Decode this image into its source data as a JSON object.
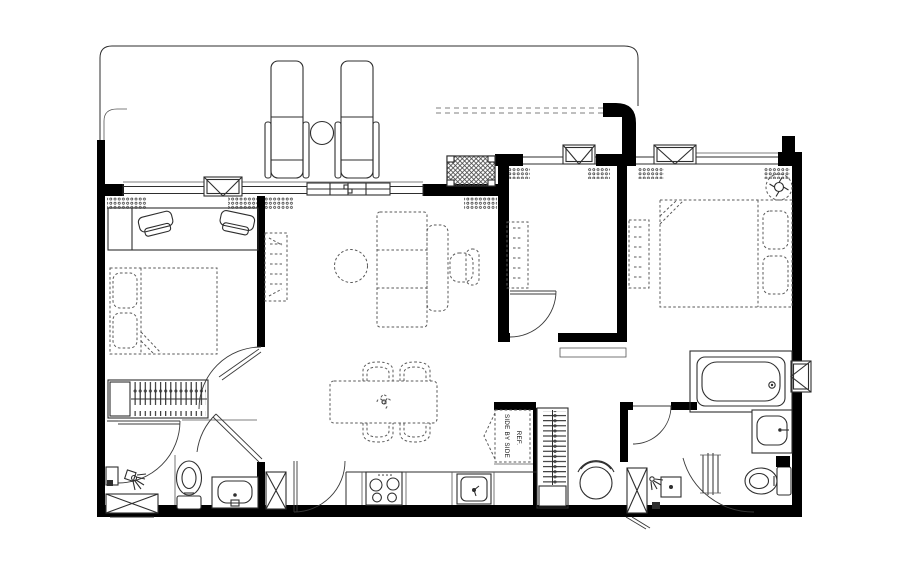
{
  "canvas": {
    "width": 900,
    "height": 563,
    "background": "#ffffff"
  },
  "palette": {
    "wall": "#000000",
    "line": "#2e2e2e",
    "furniture_dash": "#5a5a5a",
    "hatch": "#2e2e2e",
    "background": "#ffffff"
  },
  "labels": {
    "refrigerator_line1": "REF.",
    "refrigerator_line2": "SIDE BY SIDE"
  },
  "plan": {
    "type": "apartment-floor-plan",
    "areas": {
      "balcony": [
        "sun-lounger",
        "sun-lounger",
        "round-side-table",
        "railing"
      ],
      "bedroom_left": [
        "desk",
        "desk-chair",
        "desk-chair",
        "double-bed",
        "wardrobe-hanging",
        "door"
      ],
      "living_room": [
        "tv-unit",
        "round-coffee-table",
        "three-seat-sofa",
        "armchair",
        "ac-unit",
        "window",
        "sliding-window"
      ],
      "dining": [
        "square-table",
        "tub-chair",
        "tub-chair",
        "tub-chair",
        "tub-chair",
        "centerpiece"
      ],
      "kitchen": [
        "counter",
        "cooktop-4-burner",
        "sink",
        "refrigerator-side-by-side",
        "door"
      ],
      "middle_room": [
        "wardrobe",
        "window",
        "door"
      ],
      "hallway": [
        "threshold",
        "closet-hanging",
        "stool"
      ],
      "bathroom_left": [
        "shower",
        "toilet",
        "vanity-sink",
        "washer-ledge",
        "shaft",
        "door"
      ],
      "master_bedroom": [
        "double-bed",
        "pillow",
        "pillow",
        "dresser",
        "ceiling-fan",
        "window"
      ],
      "master_bathroom": [
        "bathtub",
        "vanity-sink",
        "toilet",
        "towel-rail",
        "shower-basin",
        "floor-drain",
        "window",
        "door"
      ]
    }
  }
}
